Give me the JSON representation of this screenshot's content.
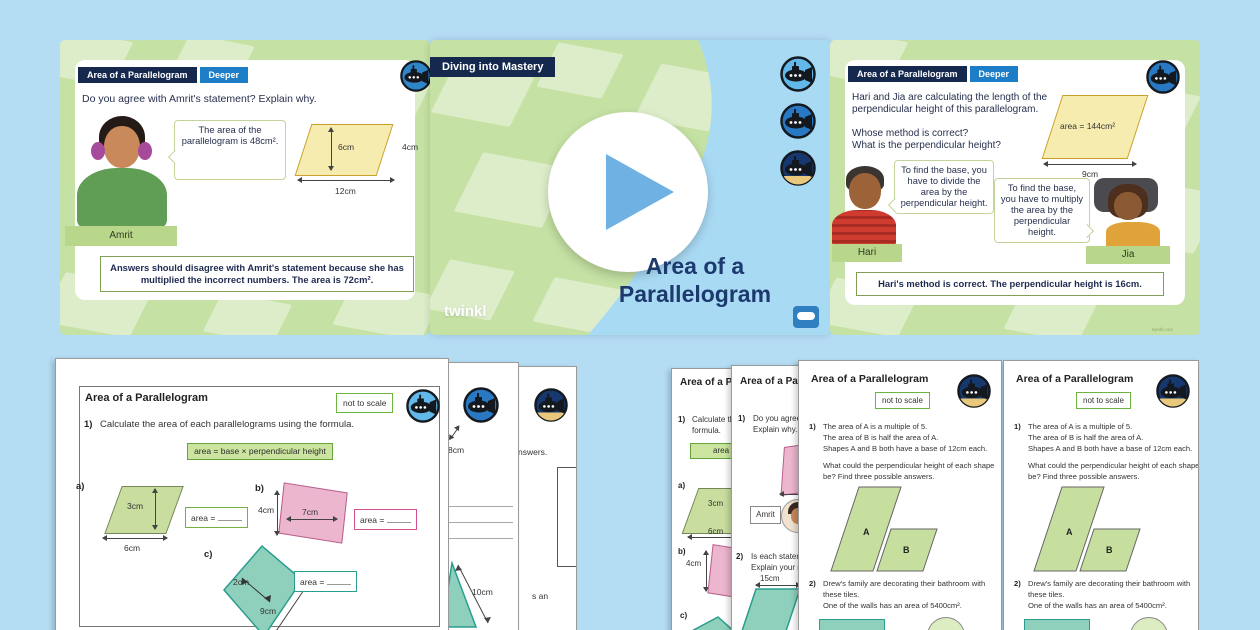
{
  "colors": {
    "canvas_bg": "#b4ddf4",
    "slide_green": "#c5e1a3",
    "navy": "#15294e",
    "badge_blue": "#1d7ec7",
    "parallelogram_yellow": "#f7ecb0",
    "worksheet_green": "#c9dd9f",
    "worksheet_pink": "#ecb6ce",
    "worksheet_teal": "#8fd0bd",
    "play_triangle": "#6fb1e2",
    "center_blob_blue": "#a9daf4"
  },
  "slide_left": {
    "header_title": "Area of a Parallelogram",
    "badge": "Deeper",
    "prompt": "Do you agree with Amrit's statement? Explain why.",
    "speech": "The area of the parallelogram is 48cm².",
    "shape_height": "6cm",
    "shape_side": "4cm",
    "shape_base": "12cm",
    "character_name": "Amrit",
    "answer": "Answers should disagree with Amrit's statement because she has multiplied the incorrect numbers. The area is 72cm²."
  },
  "slide_center": {
    "banner": "Diving into Mastery",
    "title_line1": "Area of a",
    "title_line2": "Parallelogram",
    "logo_text": "twinkl"
  },
  "slide_right": {
    "header_title": "Area of a Parallelogram",
    "badge": "Deeper",
    "prompt_line1": "Hari and Jia are calculating the length of the",
    "prompt_line2": "perpendicular height of this parallelogram.",
    "question1": "Whose method is correct?",
    "question2": "What is the perpendicular height?",
    "shape_area": "area = 144cm²",
    "shape_base": "9cm",
    "hari_speech": "To find the base, you have to divide the area by the perpendicular height.",
    "jia_speech": "To find the base, you have to multiply the area by the perpendicular height.",
    "hari_name": "Hari",
    "jia_name": "Jia",
    "answer": "Hari's method is correct. The perpendicular height is 16cm.",
    "watermark": "twinkl.com"
  },
  "worksheet": {
    "title": "Area of a Parallelogram",
    "not_to_scale": "not to scale",
    "q1_label": "1)",
    "q1_text": "Calculate the area of each parallelograms using the formula.",
    "formula": "area = base × perpendicular height",
    "item_a_label": "a)",
    "item_a_height": "3cm",
    "item_a_base": "6cm",
    "item_b_label": "b)",
    "item_b_height": "4cm",
    "item_b_base": "7cm",
    "item_c_label": "c)",
    "item_c_height": "2cm",
    "item_c_base": "9cm",
    "area_label": "area ="
  },
  "left_stack": {
    "page2_dim": "8cm",
    "page2_triangle_dim": "10cm",
    "page3_fragment1": "nswers.",
    "page3_fragment2": "s an"
  },
  "right_stack": {
    "pageA_title": "Area of a Pa",
    "pageA_q1a": "Calculate th",
    "pageA_q1b": "formula.",
    "pageA_formula": "area",
    "pageB_title": "Area of a Para",
    "pageB_q1a": "Do you agree w",
    "pageB_q1b": "Explain why.",
    "pageB_name": "Amrit",
    "pageB_q2_label": "2)",
    "pageB_q2a": "Is each stateme",
    "pageB_q2b": "Explain your re",
    "pageB_dim": "15cm",
    "deep_page": {
      "title": "Area of a Parallelogram",
      "not_to_scale": "not to scale",
      "q1_label": "1)",
      "q1_line1": "The area of A is a multiple of 5.",
      "q1_line2": "The area of B is half the area of A.",
      "q1_line3": "Shapes A and B both have a base of 12cm each.",
      "q1_line4": "What could the perpendicular height of each shape",
      "q1_line5": "be? Find three possible answers.",
      "label_a": "A",
      "label_b": "B",
      "q2_label": "2)",
      "q2_line1": "Drew's family are decorating their bathroom with",
      "q2_line2": "these tiles.",
      "q2_line3": "One of the walls has an area of 5400cm²."
    }
  }
}
